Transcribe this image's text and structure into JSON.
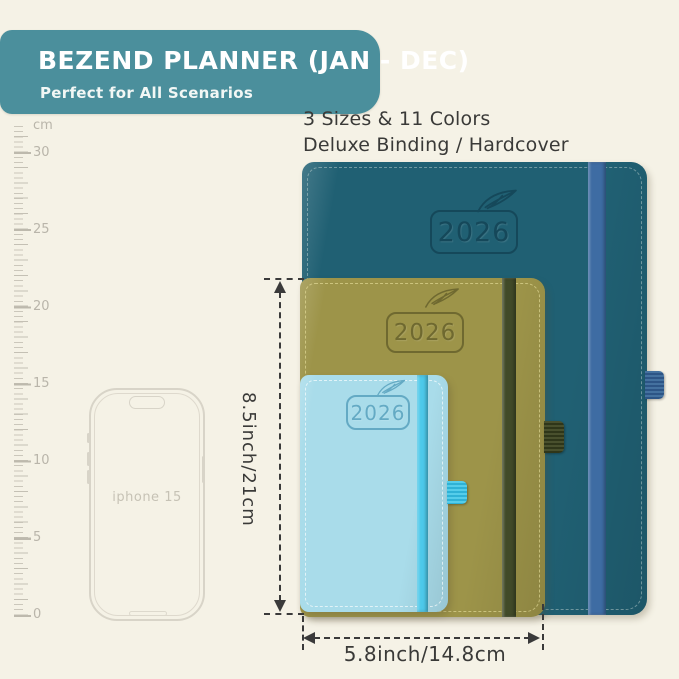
{
  "banner": {
    "title": "BEZEND PLANNER (JAN - DEC)",
    "subtitle": "Perfect for All Scenarios"
  },
  "features": {
    "line1": "3 Sizes & 11 Colors",
    "line2": "Deluxe Binding / Hardcover"
  },
  "ruler": {
    "unit_label": "cm",
    "labels": [
      "30",
      "25",
      "20",
      "15",
      "10",
      "5",
      "0"
    ]
  },
  "phone": {
    "label": "iphone 15"
  },
  "planners": {
    "large": {
      "year": "2026"
    },
    "medium": {
      "year": "2026"
    },
    "small": {
      "year": "2026"
    }
  },
  "dimensions": {
    "height_label": "8.5inch/21cm",
    "width_label": "5.8inch/14.8cm"
  },
  "colors": {
    "background": "#f5f2e6",
    "banner": "#4b8f9c",
    "text_dark": "#3a3a38",
    "ruler_tick": "#c4c0b4",
    "cover_large": "#206073",
    "cover_medium": "#9d9449",
    "cover_small": "#a9dcea",
    "band_large": "#3e6ca3",
    "band_medium": "#414a28",
    "band_small": "#4dc9ea",
    "emboss_large": "#15485a",
    "emboss_medium": "#6f6930",
    "emboss_small": "#64aac4",
    "dimension_line": "#3a3a3a"
  }
}
